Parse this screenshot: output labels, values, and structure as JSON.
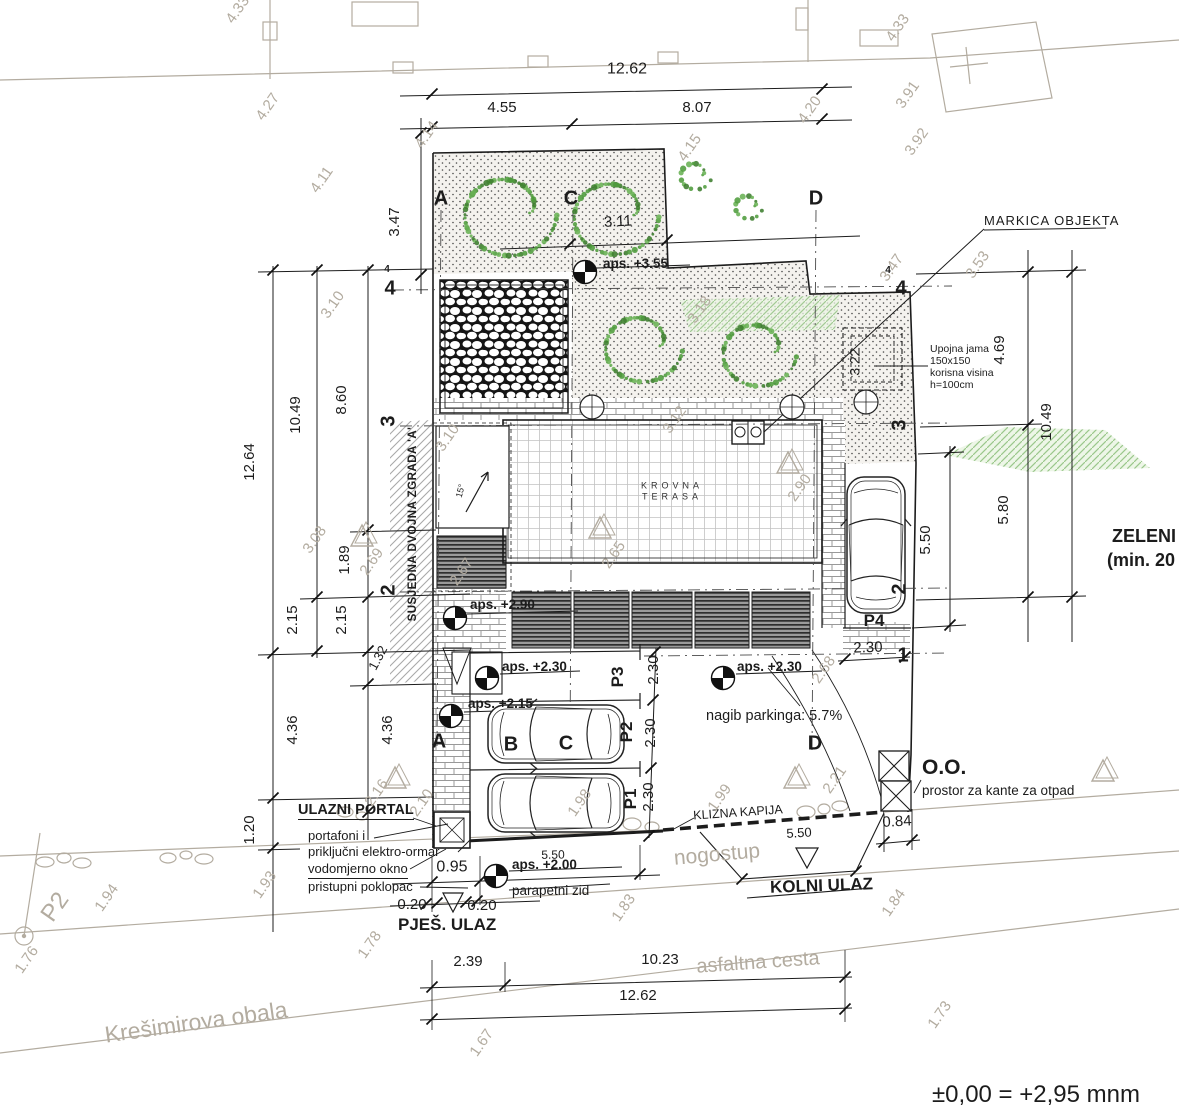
{
  "annotations": {
    "markica_objekta": "MARKICA OBJEKTA",
    "upojna_jama_line1": "Upojna jama",
    "upojna_jama_line2": "150x150",
    "upojna_jama_line3": "korisna visina",
    "upojna_jama_line4": "h=100cm",
    "zeleni_line1": "ZELENI",
    "zeleni_line2": "(min. 20",
    "oo_title": "O.O.",
    "oo_subtitle": "prostor za kante za otpad",
    "nagib_parkinga": "nagib parkinga: 5.7%",
    "krovna_line1": "KROVNA",
    "krovna_line2": "TERASA",
    "susjedna_zgrada": "SUSJEDNA DVOJNA ZGRADA 'A'",
    "ulazni_portal": "ULAZNI PORTAL",
    "portafoni": "portafoni i",
    "prikljucni": "priključni elektro-ormar",
    "vodomjerno": "vodomjerno okno",
    "pristupni": "pristupni poklopac",
    "parapetni_zid": "parapetni zid",
    "pjes_ulaz": "PJEŠ. ULAZ",
    "kolni_ulaz": "KOLNI ULAZ",
    "klizna_kapija": "KLIZNA KAPIJA",
    "nogostup": "nogostup",
    "asfaltna_cesta": "asfaltna cesta",
    "kresimirova_obala": "Krešimirova obala",
    "benchmark": "±0,00 = +2,95 mnm",
    "roof_slope": "15°",
    "survey_point": "P2"
  },
  "levels": {
    "aps_355": "aps. +3.55",
    "aps_290": "aps. +2.90",
    "aps_230_left": "aps. +2.30",
    "aps_230_right": "aps. +2.30",
    "aps_215": "aps. +2.15",
    "aps_200": "aps. +2.00"
  },
  "grid": {
    "top_a": "A",
    "top_c": "C",
    "top_d": "D",
    "bottom_a": "A",
    "bottom_b": "B",
    "bottom_c": "C",
    "bottom_d": "D",
    "left_4": "4",
    "left_4s": "4",
    "left_3": "3",
    "left_2": "2",
    "right_4": "4",
    "right_4s": "4",
    "right_3": "3",
    "right_2": "2",
    "right_1": "1"
  },
  "parking": {
    "p1": "P1",
    "p2": "P2",
    "p3": "P3",
    "p4": "P4"
  },
  "dimensions": [
    "12.62",
    "4.55",
    "8.07",
    "12.64",
    "10.49",
    "8.60",
    "3.47",
    "1.89",
    "2.15",
    "2.15",
    "1.32",
    "4.36",
    "4.36",
    "1.20",
    "4.69",
    "10.49",
    "5.80",
    "5.50",
    "2.30",
    "3.11",
    "3.22",
    "2.30",
    "2.30",
    "2.30",
    "0.84",
    "5.50",
    "5.50",
    "0.95",
    "0.20",
    "0.20",
    "2.39",
    "10.23",
    "12.62"
  ],
  "spot_heights": [
    "4.33",
    "4.27",
    "4.11",
    "4.14",
    "4.15",
    "4.20",
    "4.33",
    "3.91",
    "3.92",
    "3.53",
    "3.47",
    "3.10",
    "3.10",
    "3.08",
    "3.18",
    "3.12",
    "2.90",
    "2.65",
    "2.67",
    "2.69",
    "2.68",
    "2.16",
    "2.10",
    "1.98",
    "1.99",
    "2.21",
    "1.93",
    "1.94",
    "1.76",
    "1.78",
    "1.83",
    "1.84",
    "1.67",
    "1.73"
  ],
  "colors": {
    "ink": "#1c1c1c",
    "survey": "#b3aca0",
    "tree_green": "#4f9c3c"
  }
}
